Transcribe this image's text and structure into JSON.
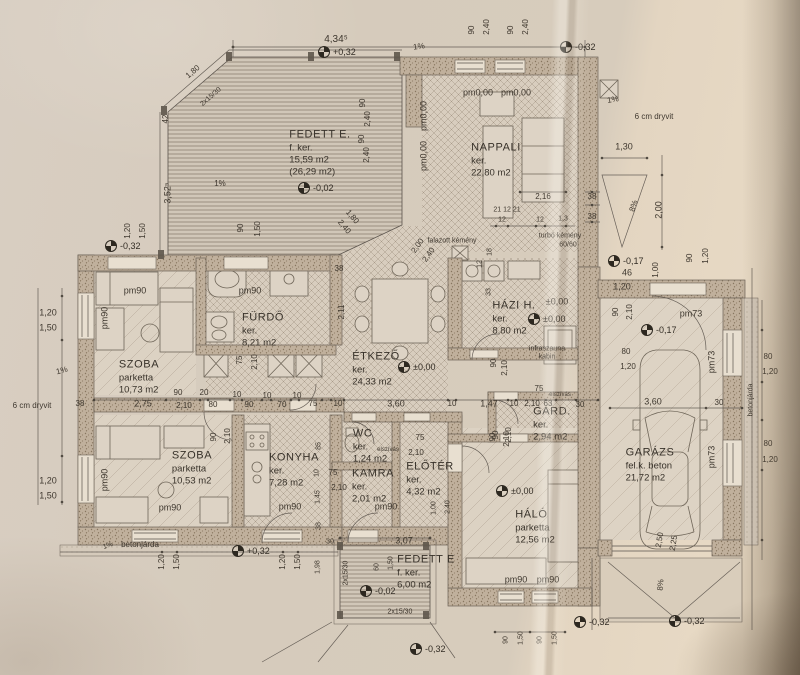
{
  "drawing_kind": "scanned architectural floor plan (Hungarian)",
  "rooms": [
    {
      "name": "FEDETT E.",
      "floor": "f. ker.",
      "area": "15,59 m2",
      "extra": "(26,29 m2)",
      "x": 320,
      "y": 153
    },
    {
      "name": "NAPPALI",
      "floor": "ker.",
      "area": "22,80 m2",
      "extra": "",
      "x": 496,
      "y": 160
    },
    {
      "name": "FÜRDŐ",
      "floor": "ker.",
      "area": "8,21 m2",
      "extra": "",
      "x": 263,
      "y": 330
    },
    {
      "name": "SZOBA",
      "floor": "parketta",
      "area": "10,73 m2",
      "extra": "",
      "x": 139,
      "y": 377
    },
    {
      "name": "ÉTKEZŐ",
      "floor": "ker.",
      "area": "24,33 m2",
      "extra": "",
      "x": 376,
      "y": 369
    },
    {
      "name": "HÁZI H.",
      "floor": "ker.",
      "area": "8,80 m2",
      "extra": "",
      "x": 514,
      "y": 318
    },
    {
      "name": "SZOBA",
      "floor": "parketta",
      "area": "10,53 m2",
      "extra": "",
      "x": 192,
      "y": 468
    },
    {
      "name": "KONYHA",
      "floor": "ker.",
      "area": "7,28 m2",
      "extra": "",
      "x": 294,
      "y": 470
    },
    {
      "name": "WC",
      "floor": "ker.",
      "area": "1,24 m2",
      "extra": "",
      "x": 370,
      "y": 446
    },
    {
      "name": "KAMRA",
      "floor": "ker.",
      "area": "2,01 m2",
      "extra": "",
      "x": 373,
      "y": 486
    },
    {
      "name": "ELŐTÉR",
      "floor": "ker.",
      "area": "4,32 m2",
      "extra": "",
      "x": 430,
      "y": 479
    },
    {
      "name": "GARD.",
      "floor": "ker.",
      "area": "2,94 m2",
      "extra": "",
      "x": 552,
      "y": 424
    },
    {
      "name": "HÁLÓ",
      "floor": "parketta",
      "area": "12,56 m2",
      "extra": "",
      "x": 535,
      "y": 527
    },
    {
      "name": "GARÁZS",
      "floor": "fel.k. beton",
      "area": "21,72 m2",
      "extra": "",
      "x": 650,
      "y": 465
    },
    {
      "name": "FEDETT E",
      "floor": "f. ker.",
      "area": "6,00 m2",
      "extra": "",
      "x": 426,
      "y": 572
    }
  ],
  "level_marks": [
    {
      "t": "+0,32",
      "x": 318,
      "y": 52
    },
    {
      "t": "-0,32",
      "x": 560,
      "y": 47
    },
    {
      "t": "-0,02",
      "x": 298,
      "y": 188
    },
    {
      "t": "±0,00",
      "x": 398,
      "y": 367
    },
    {
      "t": "±0,00",
      "x": 528,
      "y": 319
    },
    {
      "t": "-0,17",
      "x": 608,
      "y": 261
    },
    {
      "t": "-0,17",
      "x": 641,
      "y": 330
    },
    {
      "t": "±0,00",
      "x": 496,
      "y": 491
    },
    {
      "t": "+0,32",
      "x": 232,
      "y": 551
    },
    {
      "t": "-0,02",
      "x": 360,
      "y": 591
    },
    {
      "t": "-0,32",
      "x": 410,
      "y": 649
    },
    {
      "t": "-0,32",
      "x": 574,
      "y": 622
    },
    {
      "t": "-0,32",
      "x": 669,
      "y": 621
    },
    {
      "t": "-0,32",
      "x": 105,
      "y": 246
    }
  ],
  "labels": [
    {
      "t": "4,34⁵",
      "x": 336,
      "y": 40,
      "s": 10
    },
    {
      "t": "90",
      "x": 472,
      "y": 30,
      "r": -90,
      "s": 8
    },
    {
      "t": "2,40",
      "x": 487,
      "y": 27,
      "r": -90,
      "s": 8
    },
    {
      "t": "90",
      "x": 511,
      "y": 30,
      "r": -90,
      "s": 8
    },
    {
      "t": "2,40",
      "x": 526,
      "y": 27,
      "r": -90,
      "s": 8
    },
    {
      "t": "1%",
      "x": 419,
      "y": 47,
      "r": -8,
      "s": 8
    },
    {
      "t": "1,80",
      "x": 193,
      "y": 72,
      "r": -41,
      "s": 8
    },
    {
      "t": "2x15/30",
      "x": 211,
      "y": 97,
      "r": -41,
      "s": 7
    },
    {
      "t": "42",
      "x": 166,
      "y": 119,
      "r": -90,
      "s": 8
    },
    {
      "t": "3,52⁵",
      "x": 168,
      "y": 193,
      "r": -90,
      "s": 9
    },
    {
      "t": "1,20",
      "x": 128,
      "y": 231,
      "r": -90,
      "s": 8
    },
    {
      "t": "1,50",
      "x": 143,
      "y": 231,
      "r": -90,
      "s": 8
    },
    {
      "t": "1%",
      "x": 220,
      "y": 184,
      "s": 8
    },
    {
      "t": "90",
      "x": 241,
      "y": 228,
      "r": -90,
      "s": 8
    },
    {
      "t": "1,50",
      "x": 258,
      "y": 229,
      "r": -90,
      "s": 8
    },
    {
      "t": "90",
      "x": 363,
      "y": 103,
      "r": -90,
      "s": 8
    },
    {
      "t": "2,40",
      "x": 368,
      "y": 119,
      "r": -90,
      "s": 8
    },
    {
      "t": "90",
      "x": 362,
      "y": 139,
      "r": -90,
      "s": 8
    },
    {
      "t": "2,40",
      "x": 367,
      "y": 155,
      "r": -90,
      "s": 8
    },
    {
      "t": "1,80",
      "x": 352,
      "y": 217,
      "r": 50,
      "s": 8
    },
    {
      "t": "2,40",
      "x": 344,
      "y": 227,
      "r": 50,
      "s": 8
    },
    {
      "t": "2,00",
      "x": 418,
      "y": 246,
      "r": -55,
      "s": 8
    },
    {
      "t": "2,40",
      "x": 429,
      "y": 255,
      "r": -55,
      "s": 8
    },
    {
      "t": "pm0,00",
      "x": 478,
      "y": 93,
      "s": 9
    },
    {
      "t": "pm0,00",
      "x": 516,
      "y": 93,
      "s": 9
    },
    {
      "t": "pm0,00",
      "x": 424,
      "y": 116,
      "r": -90,
      "s": 9
    },
    {
      "t": "pm0,00",
      "x": 424,
      "y": 156,
      "r": -90,
      "s": 9
    },
    {
      "t": "2,16",
      "x": 543,
      "y": 197,
      "s": 8
    },
    {
      "t": "38",
      "x": 592,
      "y": 197,
      "s": 8
    },
    {
      "t": "21 12 21",
      "x": 507,
      "y": 210,
      "s": 7
    },
    {
      "t": "12",
      "x": 502,
      "y": 220,
      "s": 7
    },
    {
      "t": "12",
      "x": 540,
      "y": 220,
      "s": 7
    },
    {
      "t": "1,3",
      "x": 563,
      "y": 219,
      "s": 7
    },
    {
      "t": "38",
      "x": 592,
      "y": 217,
      "s": 8
    },
    {
      "t": "falazott kémény",
      "x": 452,
      "y": 241,
      "s": 7
    },
    {
      "t": "turbó kémény",
      "x": 560,
      "y": 236,
      "s": 7
    },
    {
      "t": "60/60",
      "x": 568,
      "y": 245,
      "s": 7
    },
    {
      "t": "1%",
      "x": 613,
      "y": 100,
      "r": -10,
      "s": 8
    },
    {
      "t": "6 cm dryvit",
      "x": 654,
      "y": 117,
      "s": 8
    },
    {
      "t": "1,30",
      "x": 624,
      "y": 147,
      "s": 9
    },
    {
      "t": "8%",
      "x": 634,
      "y": 206,
      "r": -72,
      "s": 8
    },
    {
      "t": "2,00",
      "x": 659,
      "y": 210,
      "r": -90,
      "s": 9
    },
    {
      "t": "46",
      "x": 627,
      "y": 273,
      "s": 9
    },
    {
      "t": "1,00",
      "x": 656,
      "y": 270,
      "r": -90,
      "s": 8
    },
    {
      "t": "90",
      "x": 690,
      "y": 258,
      "r": -90,
      "s": 8
    },
    {
      "t": "1,20",
      "x": 706,
      "y": 256,
      "r": -90,
      "s": 8
    },
    {
      "t": "1,20",
      "x": 622,
      "y": 287,
      "s": 9
    },
    {
      "t": "±0,00",
      "x": 557,
      "y": 302,
      "s": 9
    },
    {
      "t": "pm90",
      "x": 135,
      "y": 291,
      "s": 9
    },
    {
      "t": "pm90",
      "x": 250,
      "y": 291,
      "s": 9
    },
    {
      "t": "pm90",
      "x": 105,
      "y": 318,
      "r": -90,
      "s": 9
    },
    {
      "t": "75",
      "x": 240,
      "y": 360,
      "r": -90,
      "s": 8
    },
    {
      "t": "2,10",
      "x": 255,
      "y": 362,
      "r": -90,
      "s": 8
    },
    {
      "t": "1,20",
      "x": 48,
      "y": 313,
      "s": 9
    },
    {
      "t": "1,50",
      "x": 48,
      "y": 328,
      "s": 9
    },
    {
      "t": "1%",
      "x": 62,
      "y": 371,
      "r": -15,
      "s": 8
    },
    {
      "t": "6 cm dryvit",
      "x": 32,
      "y": 406,
      "s": 8
    },
    {
      "t": "38",
      "x": 80,
      "y": 404,
      "s": 8
    },
    {
      "t": "1,20",
      "x": 48,
      "y": 481,
      "s": 9
    },
    {
      "t": "1,50",
      "x": 48,
      "y": 496,
      "s": 9
    },
    {
      "t": "2,75",
      "x": 143,
      "y": 404,
      "s": 9
    },
    {
      "t": "90",
      "x": 178,
      "y": 393,
      "s": 8
    },
    {
      "t": "2,10",
      "x": 184,
      "y": 406,
      "s": 8
    },
    {
      "t": "20",
      "x": 204,
      "y": 393,
      "s": 8
    },
    {
      "t": "80",
      "x": 213,
      "y": 405,
      "s": 8
    },
    {
      "t": "10",
      "x": 237,
      "y": 395,
      "s": 8
    },
    {
      "t": "90",
      "x": 249,
      "y": 405,
      "s": 8
    },
    {
      "t": "10",
      "x": 267,
      "y": 396,
      "s": 8
    },
    {
      "t": "70",
      "x": 282,
      "y": 405,
      "s": 8
    },
    {
      "t": "10",
      "x": 297,
      "y": 396,
      "s": 8
    },
    {
      "t": "75",
      "x": 313,
      "y": 404,
      "s": 8
    },
    {
      "t": "10",
      "x": 338,
      "y": 404,
      "s": 8
    },
    {
      "t": "3,60",
      "x": 396,
      "y": 404,
      "s": 9
    },
    {
      "t": "10",
      "x": 452,
      "y": 404,
      "s": 8
    },
    {
      "t": "1,47",
      "x": 489,
      "y": 404,
      "s": 9
    },
    {
      "t": "10",
      "x": 514,
      "y": 404,
      "s": 8
    },
    {
      "t": "2,10",
      "x": 532,
      "y": 404,
      "s": 8
    },
    {
      "t": "63",
      "x": 548,
      "y": 404,
      "s": 8
    },
    {
      "t": "30",
      "x": 580,
      "y": 405,
      "s": 8
    },
    {
      "t": "2,11",
      "x": 342,
      "y": 312,
      "r": -90,
      "s": 8
    },
    {
      "t": "38",
      "x": 339,
      "y": 269,
      "s": 8
    },
    {
      "t": "18",
      "x": 490,
      "y": 252,
      "r": -90,
      "s": 7
    },
    {
      "t": "12",
      "x": 480,
      "y": 264,
      "r": -90,
      "s": 7
    },
    {
      "t": "33",
      "x": 489,
      "y": 292,
      "r": -90,
      "s": 7
    },
    {
      "t": "infraszauna",
      "x": 547,
      "y": 349,
      "s": 7
    },
    {
      "t": "kabin",
      "x": 547,
      "y": 357,
      "s": 7
    },
    {
      "t": "90",
      "x": 494,
      "y": 363,
      "r": -90,
      "s": 8
    },
    {
      "t": "2,10",
      "x": 505,
      "y": 368,
      "r": -90,
      "s": 8
    },
    {
      "t": "75",
      "x": 539,
      "y": 389,
      "s": 8
    },
    {
      "t": "elszívás",
      "x": 560,
      "y": 395,
      "s": 6
    },
    {
      "t": "90",
      "x": 496,
      "y": 435,
      "r": -90,
      "s": 8
    },
    {
      "t": "2,10",
      "x": 509,
      "y": 435,
      "r": -90,
      "s": 8
    },
    {
      "t": "pm73",
      "x": 691,
      "y": 314,
      "s": 9
    },
    {
      "t": "90",
      "x": 616,
      "y": 312,
      "r": -90,
      "s": 8
    },
    {
      "t": "2,10",
      "x": 630,
      "y": 312,
      "r": -90,
      "s": 8
    },
    {
      "t": "80",
      "x": 626,
      "y": 352,
      "s": 8
    },
    {
      "t": "1,20",
      "x": 628,
      "y": 367,
      "s": 8
    },
    {
      "t": "pm73",
      "x": 712,
      "y": 362,
      "r": -90,
      "s": 9
    },
    {
      "t": "3,60",
      "x": 653,
      "y": 402,
      "s": 9
    },
    {
      "t": "30",
      "x": 719,
      "y": 403,
      "s": 8
    },
    {
      "t": "betonjárda",
      "x": 751,
      "y": 400,
      "r": -90,
      "s": 7
    },
    {
      "t": "80",
      "x": 768,
      "y": 357,
      "s": 8
    },
    {
      "t": "1,20",
      "x": 770,
      "y": 372,
      "s": 8
    },
    {
      "t": "pm73",
      "x": 712,
      "y": 457,
      "r": -90,
      "s": 9
    },
    {
      "t": "80",
      "x": 768,
      "y": 444,
      "s": 8
    },
    {
      "t": "1,20",
      "x": 770,
      "y": 460,
      "s": 8
    },
    {
      "t": "2,50",
      "x": 660,
      "y": 540,
      "r": -80,
      "s": 8
    },
    {
      "t": "2,25",
      "x": 674,
      "y": 543,
      "r": -80,
      "s": 8
    },
    {
      "t": "8%",
      "x": 661,
      "y": 585,
      "r": -85,
      "s": 8
    },
    {
      "t": "90",
      "x": 214,
      "y": 437,
      "r": -90,
      "s": 8
    },
    {
      "t": "2,10",
      "x": 228,
      "y": 436,
      "r": -90,
      "s": 8
    },
    {
      "t": "pm90",
      "x": 105,
      "y": 480,
      "r": -90,
      "s": 9
    },
    {
      "t": "pm90",
      "x": 170,
      "y": 508,
      "s": 9
    },
    {
      "t": "pm90",
      "x": 290,
      "y": 507,
      "s": 9
    },
    {
      "t": "85",
      "x": 319,
      "y": 446,
      "r": -90,
      "s": 7
    },
    {
      "t": "10",
      "x": 317,
      "y": 473,
      "r": -90,
      "s": 7
    },
    {
      "t": "1,45",
      "x": 318,
      "y": 497,
      "r": -90,
      "s": 7
    },
    {
      "t": "75",
      "x": 333,
      "y": 473,
      "s": 8
    },
    {
      "t": "2,10",
      "x": 339,
      "y": 488,
      "s": 8
    },
    {
      "t": "elszívás",
      "x": 388,
      "y": 450,
      "s": 6
    },
    {
      "t": "75",
      "x": 420,
      "y": 438,
      "s": 8
    },
    {
      "t": "2,10",
      "x": 416,
      "y": 453,
      "s": 8
    },
    {
      "t": "pm90",
      "x": 386,
      "y": 507,
      "s": 9
    },
    {
      "t": "1,00",
      "x": 434,
      "y": 508,
      "r": -90,
      "s": 7
    },
    {
      "t": "2,40",
      "x": 448,
      "y": 507,
      "r": -90,
      "s": 7
    },
    {
      "t": "90",
      "x": 493,
      "y": 437,
      "r": -90,
      "s": 8
    },
    {
      "t": "2,10",
      "x": 507,
      "y": 439,
      "r": -90,
      "s": 8
    },
    {
      "t": "pm90",
      "x": 516,
      "y": 580,
      "s": 9
    },
    {
      "t": "pm90",
      "x": 548,
      "y": 580,
      "s": 9
    },
    {
      "t": "38",
      "x": 319,
      "y": 526,
      "r": -90,
      "s": 7
    },
    {
      "t": "30",
      "x": 330,
      "y": 542,
      "s": 7
    },
    {
      "t": "1,98",
      "x": 318,
      "y": 567,
      "r": -90,
      "s": 7
    },
    {
      "t": "1%",
      "x": 108,
      "y": 546,
      "r": -20,
      "s": 7
    },
    {
      "t": "betonjárda",
      "x": 140,
      "y": 545,
      "s": 8
    },
    {
      "t": "1,20",
      "x": 162,
      "y": 562,
      "r": -90,
      "s": 8
    },
    {
      "t": "1,50",
      "x": 177,
      "y": 562,
      "r": -90,
      "s": 8
    },
    {
      "t": "1,20",
      "x": 283,
      "y": 562,
      "r": -90,
      "s": 8
    },
    {
      "t": "1,50",
      "x": 298,
      "y": 562,
      "r": -90,
      "s": 8
    },
    {
      "t": "3,07",
      "x": 404,
      "y": 541,
      "s": 9
    },
    {
      "t": "2x15/30",
      "x": 346,
      "y": 573,
      "r": -90,
      "s": 7
    },
    {
      "t": "60",
      "x": 377,
      "y": 567,
      "r": -90,
      "s": 7
    },
    {
      "t": "1,50",
      "x": 391,
      "y": 563,
      "r": -90,
      "s": 7
    },
    {
      "t": "2x15/30",
      "x": 400,
      "y": 612,
      "s": 7
    },
    {
      "t": "90",
      "x": 506,
      "y": 640,
      "r": -90,
      "s": 7
    },
    {
      "t": "1,50",
      "x": 521,
      "y": 638,
      "r": -90,
      "s": 7
    },
    {
      "t": "90",
      "x": 540,
      "y": 640,
      "r": -90,
      "s": 7
    },
    {
      "t": "1,50",
      "x": 555,
      "y": 638,
      "r": -90,
      "s": 7
    }
  ],
  "colors": {
    "paper": "#d7ccbd",
    "ink": "#3e372e",
    "wall_fill": "#c0b09c",
    "tile_line": "#a89a89"
  }
}
